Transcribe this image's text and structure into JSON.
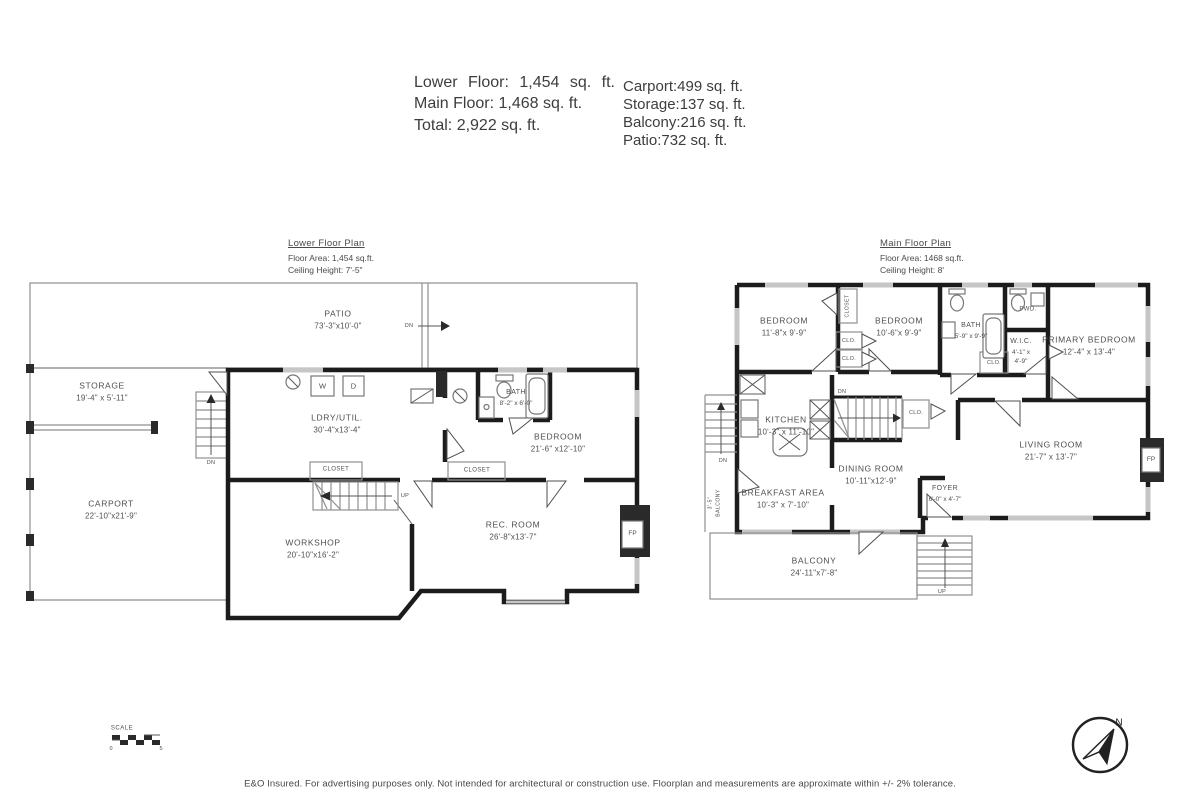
{
  "header": {
    "lower_floor": "Lower Floor: 1,454 sq. ft.",
    "main_floor": "Main Floor: 1,468 sq. ft.",
    "total": "Total: 2,922 sq. ft.",
    "carport": "Carport:499 sq. ft.",
    "storage": "Storage:137 sq. ft.",
    "balcony": "Balcony:216 sq. ft.",
    "patio": "Patio:732 sq. ft."
  },
  "lower": {
    "title": "Lower Floor Plan",
    "area": "Floor Area: 1,454 sq.ft.",
    "ceiling": "Ceiling Height: 7'-5\"",
    "patio": {
      "name": "PATIO",
      "dims": "73'-3\"x10'-0\""
    },
    "storage": {
      "name": "STORAGE",
      "dims": "19'-4\" x 5'-11\""
    },
    "ldry": {
      "name": "LDRY/UTIL.",
      "dims": "30'-4\"x13'-4\""
    },
    "bath": {
      "name": "BATH",
      "dims": "8'-2\" x 6'-0\""
    },
    "bedroom": {
      "name": "BEDROOM",
      "dims": "21'-6\" x12'-10\""
    },
    "carport": {
      "name": "CARPORT",
      "dims": "22'-10\"x21'-9\""
    },
    "workshop": {
      "name": "WORKSHOP",
      "dims": "20'-10\"x16'-2\""
    },
    "recroom": {
      "name": "REC. ROOM",
      "dims": "26'-8\"x13'-7\""
    },
    "closet1": "CLOSET",
    "closet2": "CLOSET",
    "washer": "W",
    "dryer": "D",
    "fireplace": "FP",
    "dn_patio": "DN",
    "dn_stairs": "DN",
    "up_stairs": "UP"
  },
  "main": {
    "title": "Main Floor Plan",
    "area": "Floor Area: 1468 sq.ft.",
    "ceiling": "Ceiling Height: 8'",
    "bedroom1": {
      "name": "BEDROOM",
      "dims": "11'-8\"x 9'-9\""
    },
    "bedroom2": {
      "name": "BEDROOM",
      "dims": "10'-6\"x 9'-9\""
    },
    "bath": {
      "name": "BATH",
      "dims": "5'-9\" x 9'-9\""
    },
    "powder": "PWD.",
    "wic": {
      "name": "W.I.C.",
      "dims1": "4'-1\" x",
      "dims2": "4'-9\""
    },
    "primary": {
      "name": "PRIMARY BEDROOM",
      "dims": "12'-4\" x 13'-4\""
    },
    "kitchen": {
      "name": "KITCHEN",
      "dims": "10'-3\" x 11'-10\""
    },
    "dining": {
      "name": "DINING ROOM",
      "dims": "10'-11\"x12'-9\""
    },
    "breakfast": {
      "name": "BREAKFAST AREA",
      "dims": "10'-3\" x 7'-10\""
    },
    "foyer": {
      "name": "FOYER",
      "dims": "6'-0\" x 4'-7\""
    },
    "living": {
      "name": "LIVING ROOM",
      "dims": "21'-7\" x 13'-7\""
    },
    "balcony": {
      "name": "BALCONY",
      "dims": "24'-11\"x7'-8\""
    },
    "side_balcony": {
      "name": "BALCONY",
      "dims": "3'-5\""
    },
    "closet_v": "CLOSET",
    "clo1": "CLO.",
    "clo2": "CLO.",
    "clo3": "CLO.",
    "clo4": "CLO.",
    "fireplace": "FP",
    "dn_stairs": "DN",
    "dn_side": "DN",
    "up_stairs": "UP"
  },
  "scalebar": {
    "label": "SCALE",
    "start": "0",
    "end": "5"
  },
  "compass": {
    "north": "N"
  },
  "footer": {
    "disclaimer": "E&O Insured. For advertising purposes only. Not intended for architectural or construction use. Floorplan and measurements are approximate within +/- 2% tolerance."
  }
}
